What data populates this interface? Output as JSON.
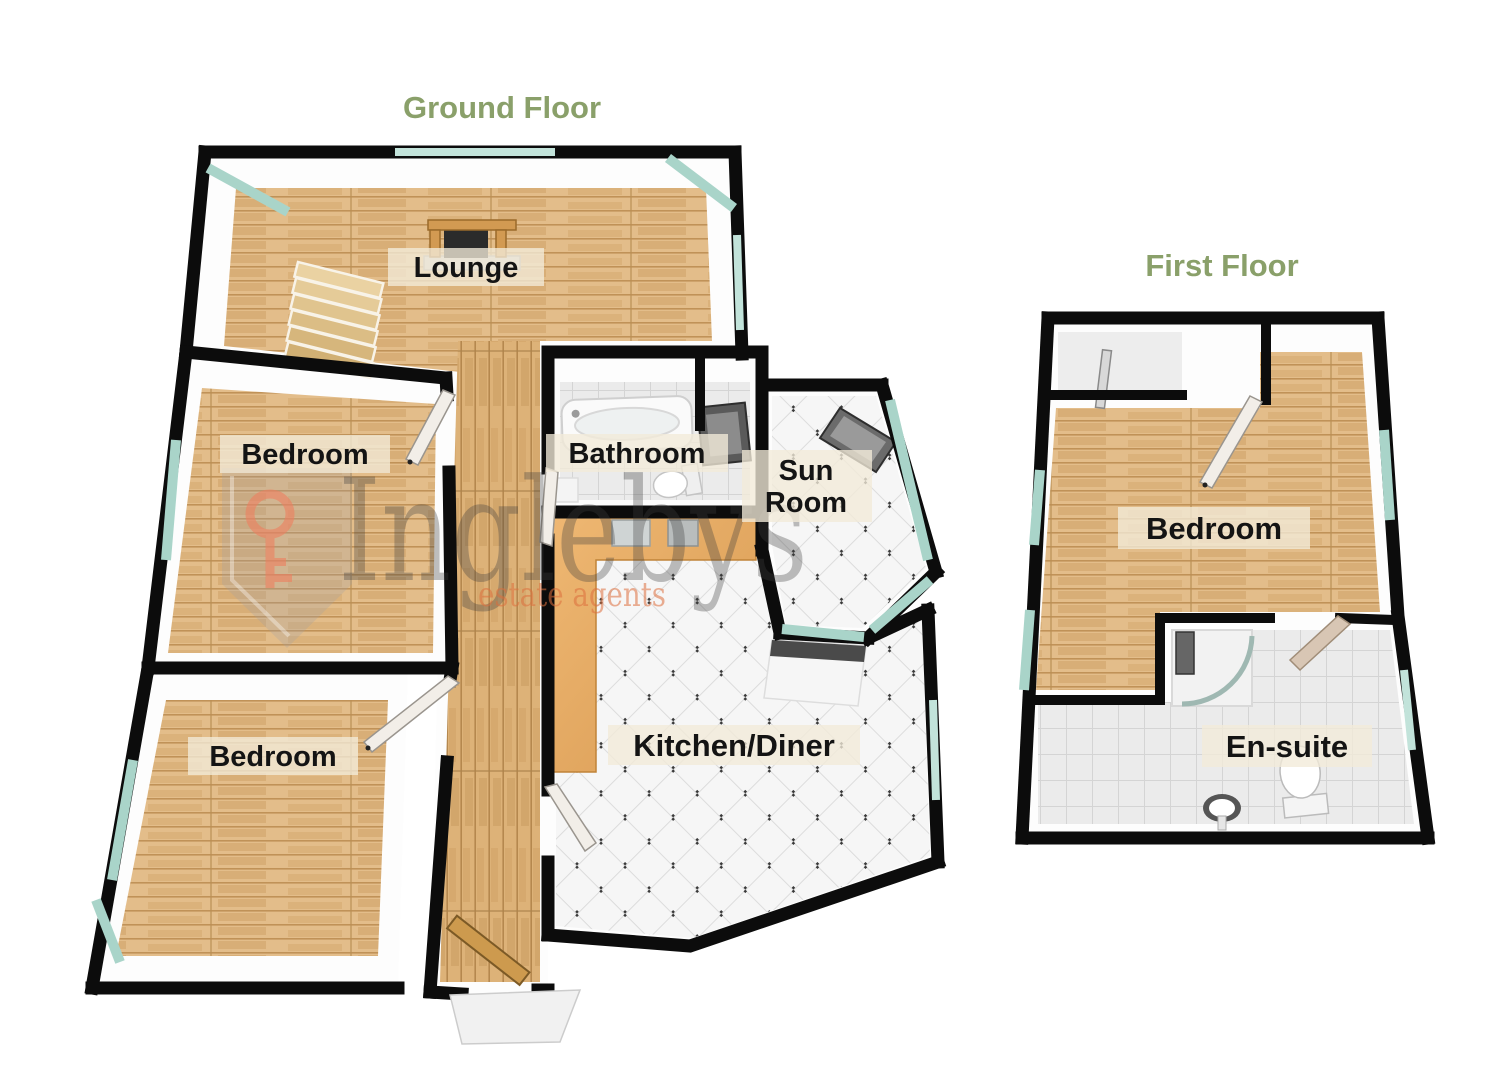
{
  "ground_floor": {
    "title": "Ground Floor",
    "rooms": {
      "lounge": "Lounge",
      "bedroom_middle": "Bedroom",
      "bathroom": "Bathroom",
      "sun_room_line1": "Sun",
      "sun_room_line2": "Room",
      "bedroom_lower": "Bedroom",
      "kitchen_diner": "Kitchen/Diner"
    }
  },
  "first_floor": {
    "title": "First Floor",
    "rooms": {
      "bedroom": "Bedroom",
      "en_suite": "En-suite"
    }
  },
  "watermark": {
    "brand": "Inglebys",
    "tagline": "estate agents"
  },
  "colors": {
    "title_green": "#8aa06a",
    "wall_black": "#0c0c0c",
    "wood_floor": "#e3bd8a",
    "hall_wood": "#ddb278",
    "tile_white": "#f6f6f6",
    "tile_grey": "#ebebeb",
    "glass_teal": "#c2e3da",
    "counter_orange": "#e6aa62",
    "entrance_door_wood": "#cd9a4e",
    "watermark_grey": "#3f3f3f",
    "watermark_orange": "#dd6f3d",
    "watermark_key": "#ee7f5f"
  }
}
